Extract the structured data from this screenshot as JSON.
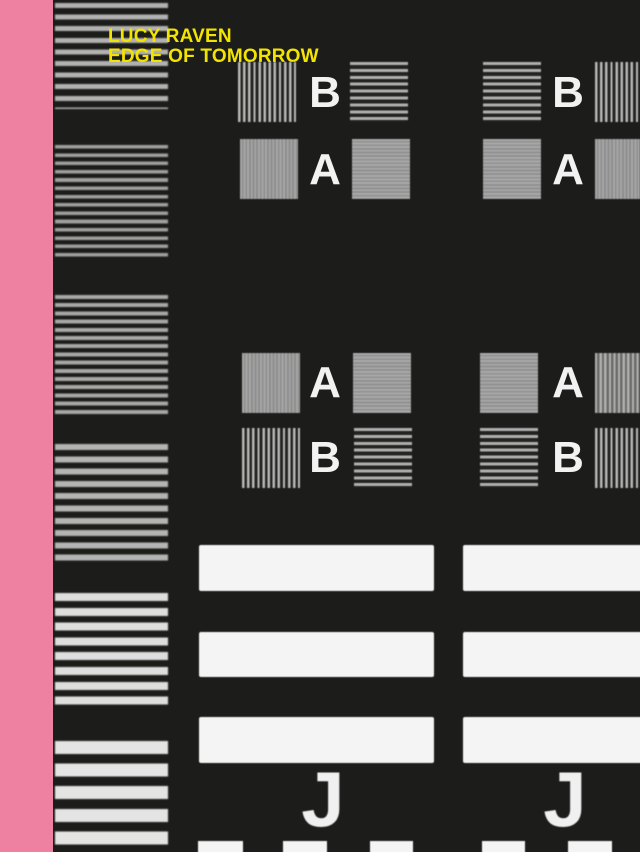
{
  "cover": {
    "title_line1": "LUCY RAVEN",
    "title_line2": "EDGE OF TOMORROW"
  },
  "colors": {
    "pink_stripe": "#ee81a1",
    "title_yellow": "#f2e400",
    "background_black": "#1c1c1a",
    "pattern_white": "#f4f4f4",
    "pattern_gray": "#a8a8a8"
  },
  "test_pattern": {
    "groups": [
      {
        "id": "top-middle",
        "rows": [
          {
            "label": "B"
          },
          {
            "label": "A"
          }
        ]
      },
      {
        "id": "top-right",
        "rows": [
          {
            "label": "B"
          },
          {
            "label": "A"
          }
        ]
      },
      {
        "id": "middle-middle",
        "rows": [
          {
            "label": "A"
          },
          {
            "label": "B"
          }
        ]
      },
      {
        "id": "middle-right",
        "rows": [
          {
            "label": "A"
          },
          {
            "label": "B"
          }
        ]
      }
    ],
    "footer_letters": [
      "J",
      "J"
    ]
  }
}
